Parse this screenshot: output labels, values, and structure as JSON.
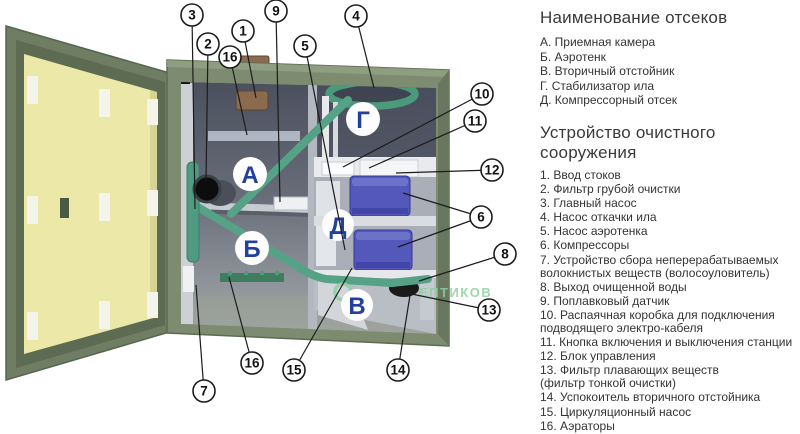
{
  "legend": {
    "compartments_title": "Наименование отсеков",
    "compartments": [
      "А. Приемная камера",
      "Б. Аэротенк",
      "В. Вторичный отстойник",
      "Г.  Стабилизатор ила",
      "Д. Компрессорный отсек"
    ],
    "devices_title": "Устройство очистного\nсооружения",
    "devices": [
      "1. Ввод стоков",
      "2. Фильтр грубой очистки",
      "3. Главный насос",
      "4. Насос откачки ила",
      "5. Насос аэротенка",
      "6. Компрессоры",
      "7. Устройство сбора неперерабатываемых\nволокнистых веществ (волосоуловитель)",
      "8. Выход очищенной воды",
      "9. Поплавковый датчик",
      "10. Распаячная коробка для подключения\nподводящего электро-кабеля",
      "11. Кнопка включения и выключения станции",
      "12. Блок управления",
      "13. Фильтр плавающих веществ\n(фильтр тонкой очистки)",
      "14. Успокоитель вторичного отстойника",
      "15. Циркуляционный насос",
      "16. Аэраторы"
    ]
  },
  "diagram": {
    "compartments": {
      "a": "А",
      "b": "Б",
      "v": "В",
      "g": "Г",
      "d": "Д"
    },
    "callouts": {
      "n1": "1",
      "n2": "2",
      "n3": "3",
      "n4": "4",
      "n5": "5",
      "n6": "6",
      "n7": "7",
      "n8": "8",
      "n9": "9",
      "n10": "10",
      "n11": "11",
      "n12": "12",
      "n13": "13",
      "n14": "14",
      "n15": "15",
      "n16": "16"
    },
    "watermark": "ЕПТИКОВ",
    "colors": {
      "door_green": "#6f7e63",
      "panel_yellow": "#ebe8a8",
      "tank_green": "#7d8c70",
      "interior_dark": "#4b505e",
      "pipe_teal": "#55a287",
      "compressor_blue": "#5358ba",
      "letter_blue": "#23409d",
      "watermark_green": "#8ecfa2",
      "inlet_brown": "#8a6b4e"
    }
  }
}
